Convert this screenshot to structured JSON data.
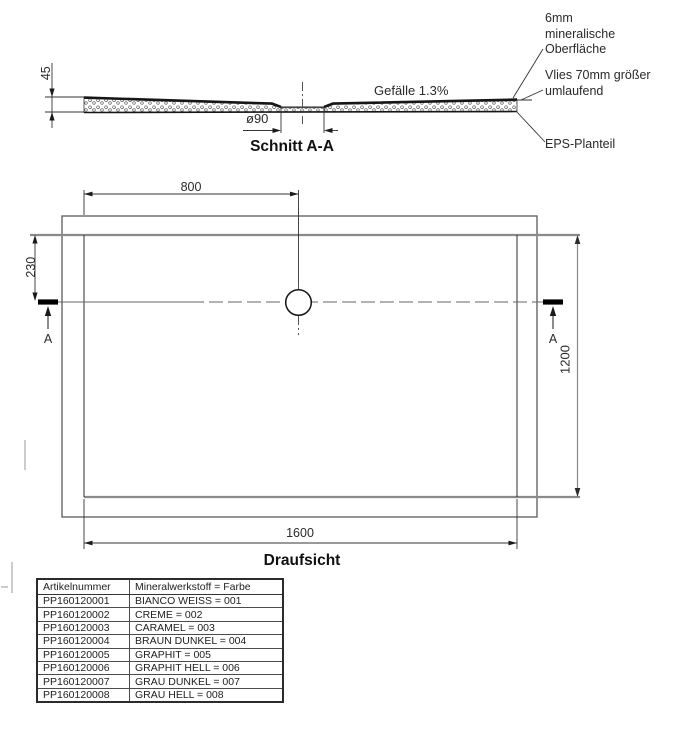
{
  "document": {
    "type": "technical-drawing-shower-tray",
    "background": "#ffffff"
  },
  "colors": {
    "line_dark": "#1c1c1c",
    "line_medium": "#4c4c4c",
    "line_gray": "#8a8a8a",
    "text": "#2a2a2a"
  },
  "section_view": {
    "title": "Schnitt A-A",
    "dim_thickness": "45",
    "dim_drain": "ø90",
    "slope_label": "Gefälle 1.3%",
    "anno_surface": "6mm\nmineralische\nOberfläche",
    "anno_vlies": "Vlies 70mm größer\numlaufend",
    "anno_eps": "EPS-Planteil"
  },
  "plan_view": {
    "title": "Draufsicht",
    "dim_drain_from_left": "800",
    "dim_drain_from_top": "230",
    "dim_width": "1200",
    "dim_length": "1600",
    "section_marker_left": "A",
    "section_marker_right": "A"
  },
  "table": {
    "headers": [
      "Artikelnummer",
      "Mineralwerkstoff = Farbe"
    ],
    "rows": [
      [
        "PP160120001",
        "BIANCO WEISS = 001"
      ],
      [
        "PP160120002",
        "CREME = 002"
      ],
      [
        "PP160120003",
        "CARAMEL = 003"
      ],
      [
        "PP160120004",
        "BRAUN DUNKEL = 004"
      ],
      [
        "PP160120005",
        "GRAPHIT = 005"
      ],
      [
        "PP160120006",
        "GRAPHIT HELL = 006"
      ],
      [
        "PP160120007",
        "GRAU DUNKEL = 007"
      ],
      [
        "PP160120008",
        "GRAU HELL = 008"
      ]
    ]
  }
}
